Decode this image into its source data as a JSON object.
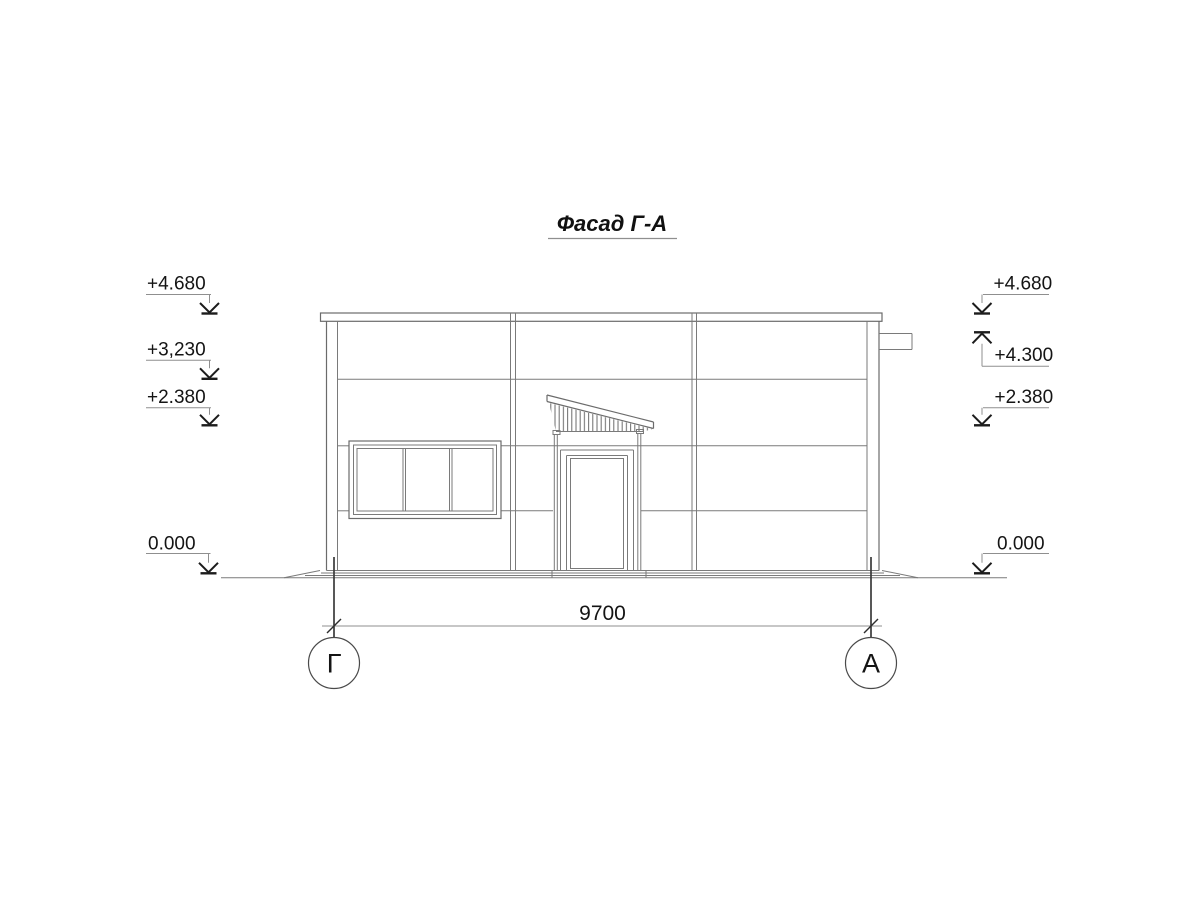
{
  "drawing": {
    "title": "Фасад Г-А",
    "dimension_label": "9700",
    "axis_labels": {
      "left": "Г",
      "right": "А"
    },
    "elevation_marks_left": [
      {
        "label": "+4.680"
      },
      {
        "label": "+3,230"
      },
      {
        "label": "+2.380"
      },
      {
        "label": "0.000"
      }
    ],
    "elevation_marks_right": [
      {
        "label": "+4.680"
      },
      {
        "label": "+4.300"
      },
      {
        "label": "+2.380"
      },
      {
        "label": "0.000"
      }
    ],
    "colors": {
      "background": "#ffffff",
      "drawing_line": "#7a7a7a",
      "text": "#141414",
      "arrow": "#1c1c1c",
      "axis_line": "#3a3a3a"
    }
  }
}
